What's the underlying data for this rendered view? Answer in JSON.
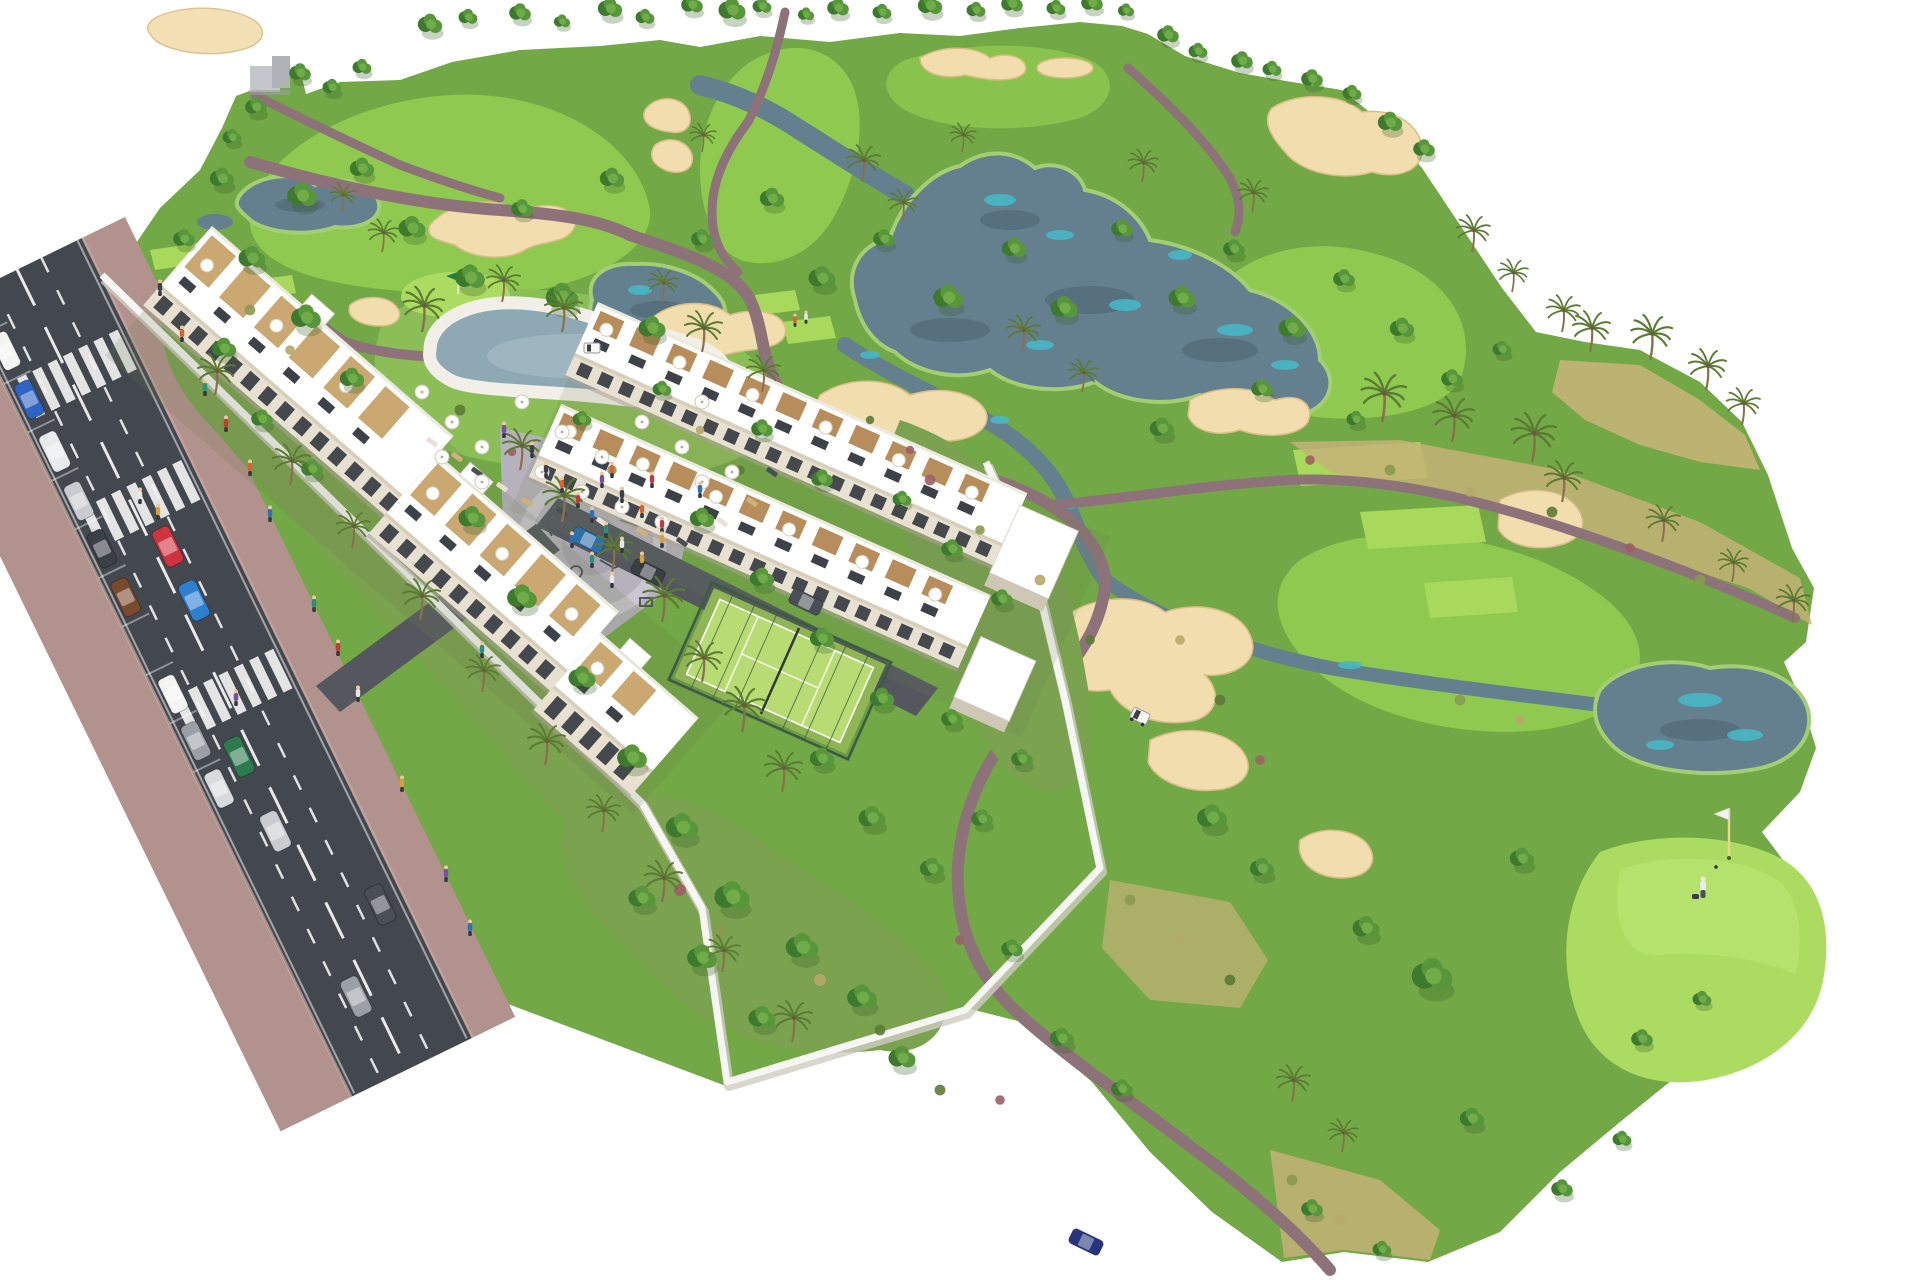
{
  "image": {
    "title": "Aerial 3D render of a golf resort residential development with apartment blocks, pool, padel court, access road and golf course"
  },
  "palette": {
    "background": "#ffffff",
    "grass": "#72a845",
    "grass_deep": "#5e9138",
    "fairway": "#8fc94f",
    "lawn": "#8cbe58",
    "green": "#abdb60",
    "green_light": "#bce876",
    "tee": "#a9d95c",
    "dry_grass": "#c4b277",
    "garden": "#7aa24f",
    "tree_dark": "#3e7a2e",
    "tree_mid": "#58963b",
    "tree_light": "#74b24c",
    "palm_frond": "#5b7a33",
    "trunk": "#8a6f4d",
    "sand": "#f2ddae",
    "sand_shadow": "#d9bd86",
    "water": "#64808f",
    "water_dark": "#526b79",
    "water_teal": "#45bac8",
    "water_light": "#8fa9b4",
    "path": "#8d7379",
    "path_light": "#a79094",
    "road": "#43474e",
    "road_mark": "#f2f2f2",
    "sidewalk": "#b2928d",
    "sidewalk_light": "#c9aba4",
    "wall": "#f6f6f3",
    "wall_shade": "#cfccc2",
    "building": "#ffffff",
    "building_face": "#e8e1d2",
    "building_shade": "#cfc7b6",
    "window": "#33383f",
    "wood": "#c8a36a",
    "wood_deep": "#b38752",
    "plaza": "#b6b2bc",
    "plaza_light": "#cbc7d2",
    "court": "#b8dc73",
    "court_dark": "#8fb554",
    "fence": "#3d5a44",
    "umbrella": "#fdfdfb",
    "cart": "#f8f8f5",
    "flag_pole": "#e6d98a",
    "driveway": "#54585e"
  },
  "scene": {
    "type": "architectural-aerial-render",
    "setting": "golf-resort-residential-development",
    "elements": [
      {
        "name": "golf-course",
        "label": "Golf course with fairways and rough"
      },
      {
        "name": "lake-central",
        "label": "Central lake with teal shallows"
      },
      {
        "name": "pond-west",
        "label": "West pond"
      },
      {
        "name": "pond-east",
        "label": "East pond with teal shallows"
      },
      {
        "name": "stream",
        "label": "Winding stream"
      },
      {
        "name": "sand-bunkers",
        "label": "Sand bunkers"
      },
      {
        "name": "cart-paths",
        "label": "Mauve cart paths"
      },
      {
        "name": "tee-boxes",
        "label": "Tee boxes"
      },
      {
        "name": "practice-green",
        "label": "Practice putting green with flag"
      },
      {
        "name": "golf-green",
        "label": "Golf green with flagstick, ball and golfer"
      },
      {
        "name": "golf-carts",
        "label": "Golf carts"
      },
      {
        "name": "access-road",
        "label": "Two-way access road with dashed lane markings"
      },
      {
        "name": "crosswalks",
        "label": "Zebra pedestrian crossings",
        "count": 3
      },
      {
        "name": "parked-cars",
        "label": "Cars parked along road",
        "count": 9
      },
      {
        "name": "moving-cars",
        "label": "Cars driving on road",
        "count": 6
      },
      {
        "name": "sidewalks",
        "label": "Pink-brown paved sidewalks"
      },
      {
        "name": "apartment-building-west",
        "label": "Long white apartment building with roof terraces and umbrellas"
      },
      {
        "name": "apartment-rows-center",
        "label": "Two central apartment rows with pergola roof terraces"
      },
      {
        "name": "swimming-pool",
        "label": "Lagoon-shaped swimming pool with sun deck"
      },
      {
        "name": "pool-lawn",
        "label": "Pool lawn with parasols and loungers"
      },
      {
        "name": "playground-plaza",
        "label": "Paved playground plaza with play equipment"
      },
      {
        "name": "padel-court",
        "label": "Fenced padel court"
      },
      {
        "name": "perimeter-wall",
        "label": "White perimeter wall"
      },
      {
        "name": "gardens",
        "label": "Communal gardens with trees and palms"
      },
      {
        "name": "clubhouse",
        "label": "Small clubhouse structure at top edge"
      },
      {
        "name": "trees",
        "label": "Round canopy trees"
      },
      {
        "name": "palm-trees",
        "label": "Palm trees"
      },
      {
        "name": "pedestrians",
        "label": "Small figures on sidewalks, plaza and pool deck"
      },
      {
        "name": "dry-grass",
        "label": "Dry scrub grass bands"
      }
    ]
  }
}
